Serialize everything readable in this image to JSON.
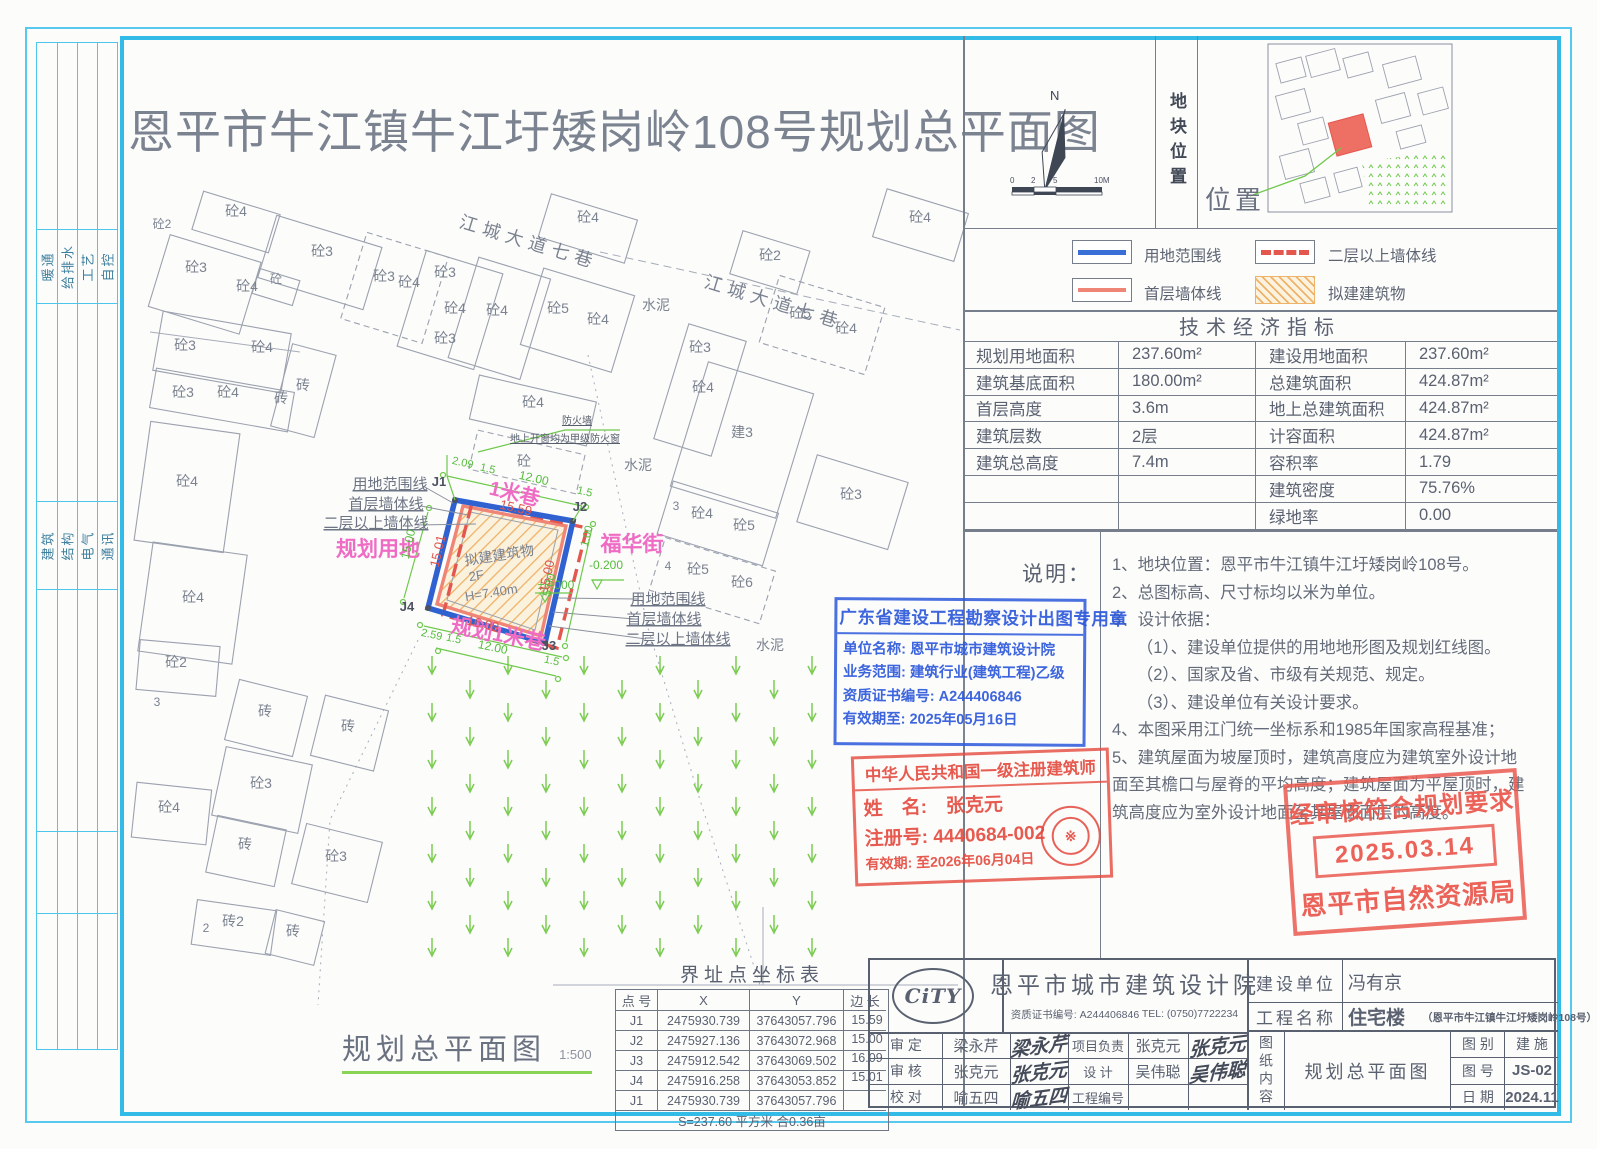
{
  "title": "恩平市牛江镇牛江圩矮岗岭108号规划总平面图",
  "frame": {
    "disciplines_top": [
      "暖通",
      "给排水",
      "工艺",
      "自控"
    ],
    "disciplines_bottom": [
      "建筑",
      "结构",
      "电气",
      "通讯"
    ]
  },
  "compass": {
    "north_label": "N",
    "scale_ticks": [
      "0",
      "2",
      "5",
      "10M"
    ]
  },
  "location_panel": {
    "vertical_label": "地块位置",
    "position_label": "位置"
  },
  "legend": {
    "items": [
      {
        "name": "用地范围线",
        "style": "blue-solid",
        "color": "#3a6fd8"
      },
      {
        "name": "二层以上墙体线",
        "style": "red-dashed",
        "color": "#e4574f"
      },
      {
        "name": "首层墙体线",
        "style": "salmon-solid",
        "color": "#ef8576"
      },
      {
        "name": "拟建建筑物",
        "style": "orange-hatch",
        "color": "#eeb268"
      }
    ]
  },
  "indicators": {
    "title": "技术经济指标",
    "rows": [
      {
        "l1": "规划用地面积",
        "v1": "237.60m²",
        "l2": "建设用地面积",
        "v2": "237.60m²"
      },
      {
        "l1": "建筑基底面积",
        "v1": "180.00m²",
        "l2": "总建筑面积",
        "v2": "424.87m²"
      },
      {
        "l1": "首层高度",
        "v1": "3.6m",
        "l2": "地上总建筑面积",
        "v2": "424.87m²"
      },
      {
        "l1": "建筑层数",
        "v1": "2层",
        "l2": "计容面积",
        "v2": "424.87m²"
      },
      {
        "l1": "建筑总高度",
        "v1": "7.4m",
        "l2": "容积率",
        "v2": "1.79"
      },
      {
        "l1": "",
        "v1": "",
        "l2": "建筑密度",
        "v2": "75.76%"
      },
      {
        "l1": "",
        "v1": "",
        "l2": "绿地率",
        "v2": "0.00"
      }
    ]
  },
  "notes": {
    "label": "说明：",
    "lines": [
      "1、地块位置：恩平市牛江镇牛江圩矮岗岭108号。",
      "2、总图标高、尺寸标均以米为单位。",
      "3、设计依据：",
      "　　（1）、建设单位提供的用地地形图及规划红线图。",
      "　　（2）、国家及省、市级有关规范、规定。",
      "　　（3）、建设单位有关设计要求。",
      "4、本图采用江门统一坐标系和1985年国家高程基准；",
      "5、建筑屋面为坡屋顶时，建筑高度应为建筑室外设计地",
      "面至其檐口与屋脊的平均高度；建筑屋面为平屋顶时，建",
      "筑高度应为室外设计地面至其屋面面层的高度。"
    ]
  },
  "stamps": {
    "blue": {
      "title": "广东省建设工程勘察设计出图专用章",
      "lines": [
        "单位名称: 恩平市城市建筑设计院",
        "业务范围: 建筑行业(建筑工程)乙级",
        "资质证书编号: A244406846",
        "有效期至: 2025年05月16日"
      ]
    },
    "architect": {
      "title": "中华人民共和国一级注册建筑师",
      "name_row": "姓　名:　张克元",
      "reg_row": "注册号: 4440684-002",
      "valid_row": "有效期: 至2026年06月04日",
      "seal_glyph": "※"
    },
    "approval": {
      "line1": "经审核符合规划要求",
      "date": "2025.03.14",
      "line2": "恩平市自然资源局"
    }
  },
  "coord_table": {
    "title": "界址点坐标表",
    "headers": [
      "点 号",
      "X",
      "Y",
      "边 长"
    ],
    "rows": [
      {
        "pt": "J1",
        "x": "2475930.739",
        "y": "37643057.796"
      },
      {
        "pt": "J2",
        "x": "2475927.136",
        "y": "37643072.968"
      },
      {
        "pt": "J3",
        "x": "2475912.542",
        "y": "37643069.502"
      },
      {
        "pt": "J4",
        "x": "2475916.258",
        "y": "37643053.852"
      },
      {
        "pt": "J1",
        "x": "2475930.739",
        "y": "37643057.796"
      }
    ],
    "edges": [
      "15.59",
      "15.00",
      "16.09",
      "15.01"
    ],
    "footer": "S=237.60 平方米 合0.36亩"
  },
  "drawing_title": {
    "name": "规划总平面图",
    "scale": "1:500"
  },
  "title_block": {
    "logo": "CiTY",
    "company": "恩平市城市建筑设计院",
    "credential": "资质证书编号: A244406846",
    "tel": "TEL: (0750)7722234",
    "personnel": [
      {
        "l": "审 定",
        "n": "梁永芹",
        "sig": "梁永芹",
        "l2": "项目负责",
        "n2": "张克元",
        "sig2": "张克元"
      },
      {
        "l": "审 核",
        "n": "张克元",
        "sig": "张克元",
        "l2": "设  计",
        "n2": "吴伟聪",
        "sig2": "吴伟聪"
      },
      {
        "l": "校 对",
        "n": "喻五四",
        "sig": "喻五四",
        "l2": "工程编号",
        "n2": "",
        "sig2": ""
      }
    ],
    "client_label": "建设单位",
    "client": "冯有京",
    "project_label": "工程名称",
    "project": "住宅楼",
    "project_sub": "（恩平市牛江镇牛江圩矮岗岭108号）",
    "content_label": "图纸内容",
    "content": "规划总平面图",
    "cat_label": "图 别",
    "cat": "建 施",
    "no_label": "图 号",
    "no": "JS-02",
    "date_label": "日 期",
    "date": "2024.11"
  },
  "plan": {
    "labels": [
      {
        "t": "砼4",
        "x": 236,
        "y": 216
      },
      {
        "t": "砼2",
        "x": 162,
        "y": 228,
        "s": 12
      },
      {
        "t": "砼3",
        "x": 196,
        "y": 272
      },
      {
        "t": "砼4",
        "x": 247,
        "y": 291
      },
      {
        "t": "砼",
        "x": 276,
        "y": 283,
        "s": 12
      },
      {
        "t": "砼3",
        "x": 322,
        "y": 256
      },
      {
        "t": "砼3",
        "x": 384,
        "y": 281
      },
      {
        "t": "砼4",
        "x": 409,
        "y": 287
      },
      {
        "t": "砼3",
        "x": 445,
        "y": 277
      },
      {
        "t": "砼4",
        "x": 455,
        "y": 313
      },
      {
        "t": "砼3",
        "x": 445,
        "y": 343
      },
      {
        "t": "砼4",
        "x": 497,
        "y": 315
      },
      {
        "t": "砼5",
        "x": 558,
        "y": 313
      },
      {
        "t": "砼4",
        "x": 598,
        "y": 324
      },
      {
        "t": "砼4",
        "x": 588,
        "y": 222
      },
      {
        "t": "砼2",
        "x": 770,
        "y": 260
      },
      {
        "t": "砼5",
        "x": 800,
        "y": 318
      },
      {
        "t": "砼4",
        "x": 846,
        "y": 333
      },
      {
        "t": "砼4",
        "x": 920,
        "y": 222
      },
      {
        "t": "砼3",
        "x": 185,
        "y": 350
      },
      {
        "t": "砼4",
        "x": 262,
        "y": 352
      },
      {
        "t": "砼3",
        "x": 183,
        "y": 397
      },
      {
        "t": "砼4",
        "x": 228,
        "y": 397
      },
      {
        "t": "砖",
        "x": 281,
        "y": 403
      },
      {
        "t": "砼4",
        "x": 187,
        "y": 486
      },
      {
        "t": "砼4",
        "x": 193,
        "y": 602
      },
      {
        "t": "砖",
        "x": 303,
        "y": 390
      },
      {
        "t": "砼4",
        "x": 533,
        "y": 407
      },
      {
        "t": "砼",
        "x": 524,
        "y": 466
      },
      {
        "t": "砼3",
        "x": 700,
        "y": 352
      },
      {
        "t": "砼4",
        "x": 703,
        "y": 392
      },
      {
        "t": "建3",
        "x": 742,
        "y": 437
      },
      {
        "t": "水泥",
        "x": 656,
        "y": 310
      },
      {
        "t": "水泥",
        "x": 638,
        "y": 470
      },
      {
        "t": "水泥",
        "x": 770,
        "y": 650
      },
      {
        "t": "3",
        "x": 676,
        "y": 510,
        "s": 12
      },
      {
        "t": "砼4",
        "x": 702,
        "y": 518
      },
      {
        "t": "砼5",
        "x": 744,
        "y": 530
      },
      {
        "t": "4",
        "x": 668,
        "y": 570,
        "s": 12
      },
      {
        "t": "砼5",
        "x": 698,
        "y": 574
      },
      {
        "t": "砼6",
        "x": 742,
        "y": 587
      },
      {
        "t": "砼3",
        "x": 851,
        "y": 499
      },
      {
        "t": "砼2",
        "x": 176,
        "y": 667
      },
      {
        "t": "3",
        "x": 157,
        "y": 706,
        "s": 12
      },
      {
        "t": "砖",
        "x": 265,
        "y": 716
      },
      {
        "t": "砖",
        "x": 348,
        "y": 731
      },
      {
        "t": "砼3",
        "x": 261,
        "y": 788
      },
      {
        "t": "砼4",
        "x": 169,
        "y": 812
      },
      {
        "t": "砖",
        "x": 245,
        "y": 849
      },
      {
        "t": "砼3",
        "x": 336,
        "y": 861
      },
      {
        "t": "砖2",
        "x": 233,
        "y": 926
      },
      {
        "t": "2",
        "x": 206,
        "y": 932,
        "s": 12
      },
      {
        "t": "砖",
        "x": 293,
        "y": 936
      },
      {
        "t": "江城大道七巷",
        "x": 527,
        "y": 248,
        "r": 17,
        "s": 18,
        "c": "g2"
      },
      {
        "t": "江城大道七巷",
        "x": 772,
        "y": 308,
        "r": 17,
        "s": 18,
        "c": "g2"
      },
      {
        "t": "防火墙",
        "x": 577,
        "y": 424,
        "s": 10,
        "c": "fire"
      },
      {
        "t": "地上开窗均为甲级防火窗",
        "x": 565,
        "y": 442,
        "s": 10,
        "c": "fire"
      },
      {
        "t": "拟建建筑物",
        "x": 500,
        "y": 560,
        "r": -9,
        "s": 14
      },
      {
        "t": "2F",
        "x": 477,
        "y": 580,
        "r": -9,
        "s": 13
      },
      {
        "t": "H=7.40m",
        "x": 492,
        "y": 597,
        "r": -9,
        "s": 13
      },
      {
        "t": "用地范围线",
        "x": 390,
        "y": 489,
        "s": 15,
        "c": "lead"
      },
      {
        "t": "首层墙体线",
        "x": 386,
        "y": 509,
        "s": 15,
        "c": "lead"
      },
      {
        "t": "二层以上墙体线",
        "x": 376,
        "y": 528,
        "s": 15,
        "c": "lead"
      },
      {
        "t": "用地范围线",
        "x": 668,
        "y": 604,
        "s": 15,
        "c": "lead"
      },
      {
        "t": "首层墙体线",
        "x": 664,
        "y": 624,
        "s": 15,
        "c": "lead"
      },
      {
        "t": "二层以上墙体线",
        "x": 678,
        "y": 644,
        "s": 15,
        "c": "lead"
      },
      {
        "t": "规划用地",
        "x": 378,
        "y": 556,
        "s": 21,
        "c": "p"
      },
      {
        "t": "1米巷",
        "x": 513,
        "y": 500,
        "r": 13,
        "s": 20,
        "c": "p"
      },
      {
        "t": "福华街",
        "x": 632,
        "y": 551,
        "s": 21,
        "c": "p"
      },
      {
        "t": "规划1米巷",
        "x": 497,
        "y": 641,
        "r": 11,
        "s": 21,
        "c": "p"
      },
      {
        "t": "2.09",
        "x": 462,
        "y": 466,
        "r": 13,
        "s": 11,
        "c": "gr"
      },
      {
        "t": "1.5",
        "x": 487,
        "y": 472,
        "r": 13,
        "s": 11,
        "c": "gr"
      },
      {
        "t": "12.00",
        "x": 533,
        "y": 482,
        "r": 13,
        "s": 12,
        "c": "gr"
      },
      {
        "t": "1.5",
        "x": 584,
        "y": 495,
        "r": 13,
        "s": 11,
        "c": "gr"
      },
      {
        "t": "15.00",
        "x": 412,
        "y": 545,
        "r": -77,
        "s": 12,
        "c": "gr"
      },
      {
        "t": "2.59",
        "x": 431,
        "y": 638,
        "r": 12,
        "s": 11,
        "c": "gr"
      },
      {
        "t": "1.5",
        "x": 453,
        "y": 642,
        "r": 12,
        "s": 11,
        "c": "gr"
      },
      {
        "t": "12.00",
        "x": 492,
        "y": 651,
        "r": 12,
        "s": 12,
        "c": "gr"
      },
      {
        "t": "1.5",
        "x": 551,
        "y": 664,
        "r": 12,
        "s": 11,
        "c": "gr"
      },
      {
        "t": "5.00",
        "x": 553,
        "y": 586,
        "r": -75,
        "s": 12,
        "c": "gr"
      },
      {
        "t": "1.00",
        "x": 590,
        "y": 537,
        "r": -75,
        "s": 11,
        "c": "gr"
      },
      {
        "t": "±0.000",
        "x": 556,
        "y": 589,
        "s": 12,
        "c": "gr"
      },
      {
        "t": "-0.200",
        "x": 606,
        "y": 569,
        "s": 12,
        "c": "gr"
      },
      {
        "t": "15.59",
        "x": 515,
        "y": 512,
        "r": 13,
        "s": 13,
        "c": "rd"
      },
      {
        "t": "15.00",
        "x": 551,
        "y": 577,
        "r": -77,
        "s": 13,
        "c": "rd"
      },
      {
        "t": "16.09",
        "x": 482,
        "y": 628,
        "r": 13,
        "s": 13,
        "c": "rd"
      },
      {
        "t": "15.01",
        "x": 442,
        "y": 552,
        "r": -77,
        "s": 13,
        "c": "rd"
      },
      {
        "t": "J1",
        "x": 439,
        "y": 486,
        "s": 13,
        "c": "j"
      },
      {
        "t": "J2",
        "x": 580,
        "y": 511,
        "s": 13,
        "c": "j"
      },
      {
        "t": "J3",
        "x": 549,
        "y": 650,
        "s": 13,
        "c": "j"
      },
      {
        "t": "J4",
        "x": 407,
        "y": 611,
        "s": 13,
        "c": "j"
      }
    ]
  }
}
